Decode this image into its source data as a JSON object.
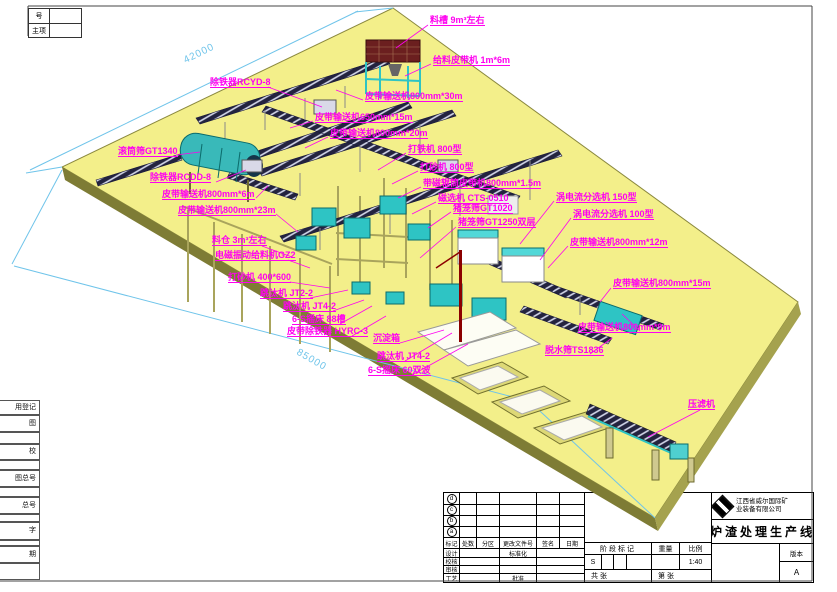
{
  "colors": {
    "label": "#ff00f0",
    "dimension": "#6fc4ea",
    "platform": "#f3ef8a",
    "platform_edge": "#7e7c35",
    "accent_teal": "#2ec4c4"
  },
  "corner_box": {
    "row1": "号",
    "row2": "主项"
  },
  "left_strip": [
    {
      "t": "用登记",
      "y": 400,
      "h": 15
    },
    {
      "t": "图",
      "y": 415,
      "h": 17
    },
    {
      "t": "",
      "y": 432,
      "h": 12
    },
    {
      "t": "校",
      "y": 444,
      "h": 16
    },
    {
      "t": "",
      "y": 460,
      "h": 10
    },
    {
      "t": "图总号",
      "y": 470,
      "h": 17
    },
    {
      "t": "",
      "y": 487,
      "h": 10
    },
    {
      "t": "总号",
      "y": 497,
      "h": 17
    },
    {
      "t": "",
      "y": 514,
      "h": 8
    },
    {
      "t": "字",
      "y": 522,
      "h": 18
    },
    {
      "t": "",
      "y": 540,
      "h": 6
    },
    {
      "t": "期",
      "y": 546,
      "h": 17
    },
    {
      "t": "",
      "y": 563,
      "h": 17
    }
  ],
  "dimensions": [
    {
      "t": "42000",
      "x": 182,
      "y": 56,
      "rot": -26
    },
    {
      "t": "85000",
      "x": 300,
      "y": 347,
      "rot": 30
    }
  ],
  "labels": [
    {
      "t": "料槽 9m³左右",
      "x": 430,
      "y": 16,
      "l": [
        428,
        25,
        396,
        48
      ]
    },
    {
      "t": "给料皮带机 1m*6m",
      "x": 433,
      "y": 56,
      "l": [
        431,
        64,
        405,
        76
      ]
    },
    {
      "t": "皮带输送机800mm*30m",
      "x": 365,
      "y": 92,
      "l": [
        363,
        100,
        336,
        90
      ]
    },
    {
      "t": "皮带输送机650mm*15m",
      "x": 315,
      "y": 113,
      "l": [
        313,
        121,
        290,
        128
      ]
    },
    {
      "t": "皮带输送机800mm*20m",
      "x": 330,
      "y": 129,
      "l": [
        328,
        137,
        305,
        148
      ]
    },
    {
      "t": "除铁器RCYD-8",
      "x": 210,
      "y": 78,
      "l": [
        268,
        87,
        322,
        107
      ]
    },
    {
      "t": "滚筒筛GT1340",
      "x": 118,
      "y": 147,
      "l": [
        176,
        155,
        200,
        152
      ]
    },
    {
      "t": "除铁器RCDD-8",
      "x": 150,
      "y": 173,
      "l": [
        216,
        182,
        246,
        170
      ]
    },
    {
      "t": "皮带输送机800mm*6m",
      "x": 162,
      "y": 190,
      "l": [
        256,
        198,
        268,
        186
      ]
    },
    {
      "t": "皮带输送机800mm*23m",
      "x": 178,
      "y": 206,
      "l": [
        276,
        214,
        298,
        232
      ]
    },
    {
      "t": "打铁机 800型",
      "x": 408,
      "y": 145,
      "l": [
        406,
        153,
        378,
        170
      ]
    },
    {
      "t": "打砂机 800型",
      "x": 420,
      "y": 163,
      "l": [
        418,
        171,
        392,
        184
      ]
    },
    {
      "t": "带磁辊筒皮带机800mm*1.5m",
      "x": 423,
      "y": 179,
      "l": [
        421,
        187,
        398,
        198
      ]
    },
    {
      "t": "磁选机 CTS-0510",
      "x": 438,
      "y": 194,
      "l": [
        436,
        202,
        412,
        214
      ]
    },
    {
      "t": "猪笼筛GT1020",
      "x": 453,
      "y": 204,
      "l": [
        451,
        212,
        428,
        228
      ]
    },
    {
      "t": "猪笼筛GT1250双层",
      "x": 458,
      "y": 218,
      "l": [
        456,
        227,
        420,
        258
      ]
    },
    {
      "t": "涡电流分选机 150型",
      "x": 556,
      "y": 193,
      "l": [
        554,
        201,
        520,
        244
      ]
    },
    {
      "t": "涡电流分选机 100型",
      "x": 573,
      "y": 210,
      "l": [
        571,
        218,
        540,
        260
      ]
    },
    {
      "t": "皮带输送机800mm*12m",
      "x": 570,
      "y": 238,
      "l": [
        568,
        246,
        548,
        268
      ]
    },
    {
      "t": "皮带输送机800mm*15m",
      "x": 613,
      "y": 279,
      "l": [
        611,
        288,
        600,
        302
      ]
    },
    {
      "t": "皮带输送机800mm*9m",
      "x": 578,
      "y": 323,
      "l": [
        640,
        331,
        622,
        314
      ]
    },
    {
      "t": "脱水筛TS1836",
      "x": 545,
      "y": 346,
      "l": [
        590,
        354,
        612,
        338
      ]
    },
    {
      "t": "压滤机",
      "x": 688,
      "y": 400,
      "l": [
        700,
        410,
        648,
        437
      ]
    },
    {
      "t": "料仓 3m³左右",
      "x": 212,
      "y": 236,
      "l": [
        262,
        246,
        292,
        257
      ]
    },
    {
      "t": "电磁振动给料机GZ2",
      "x": 215,
      "y": 251,
      "l": [
        288,
        260,
        310,
        268
      ]
    },
    {
      "t": "打砂机 400*600",
      "x": 228,
      "y": 273,
      "l": [
        290,
        282,
        330,
        288
      ]
    },
    {
      "t": "跳汰机 JT2-2",
      "x": 260,
      "y": 289,
      "l": [
        310,
        298,
        348,
        290
      ]
    },
    {
      "t": "跳汰机 JT4-2",
      "x": 283,
      "y": 302,
      "l": [
        333,
        311,
        364,
        300
      ]
    },
    {
      "t": "6-S摇床 88槽",
      "x": 292,
      "y": 315,
      "l": [
        340,
        324,
        372,
        306
      ]
    },
    {
      "t": "皮带除铁器 HYRC-3",
      "x": 287,
      "y": 327,
      "l": [
        352,
        336,
        386,
        316
      ]
    },
    {
      "t": "沉淀箱",
      "x": 373,
      "y": 334,
      "l": [
        400,
        343,
        444,
        330
      ]
    },
    {
      "t": "跳汰机 JT4-2",
      "x": 377,
      "y": 352,
      "l": [
        405,
        361,
        452,
        333
      ]
    },
    {
      "t": "6-S摇床 60双波",
      "x": 368,
      "y": 366,
      "l": [
        412,
        375,
        468,
        344
      ]
    }
  ],
  "title_block": {
    "revisions": [
      "d",
      "c",
      "b",
      "a"
    ],
    "header": [
      "标记",
      "处数",
      "分区",
      "更改文件号",
      "签名",
      "日期"
    ],
    "rows": [
      "设计",
      "校核",
      "审核",
      "工艺"
    ],
    "standardize": "标准化",
    "approve": "批准",
    "stage": "阶段标记",
    "weight": "重量",
    "scale": "比例",
    "stage_value": "S",
    "scale_value": "1:40",
    "total_sheets": "共 张",
    "sheet_no": "第 张",
    "company": [
      "江西省威尔国际矿",
      "业装备有限公司"
    ],
    "title": "炉渣处理生产线",
    "version_label": "版本",
    "version_value": "A"
  }
}
